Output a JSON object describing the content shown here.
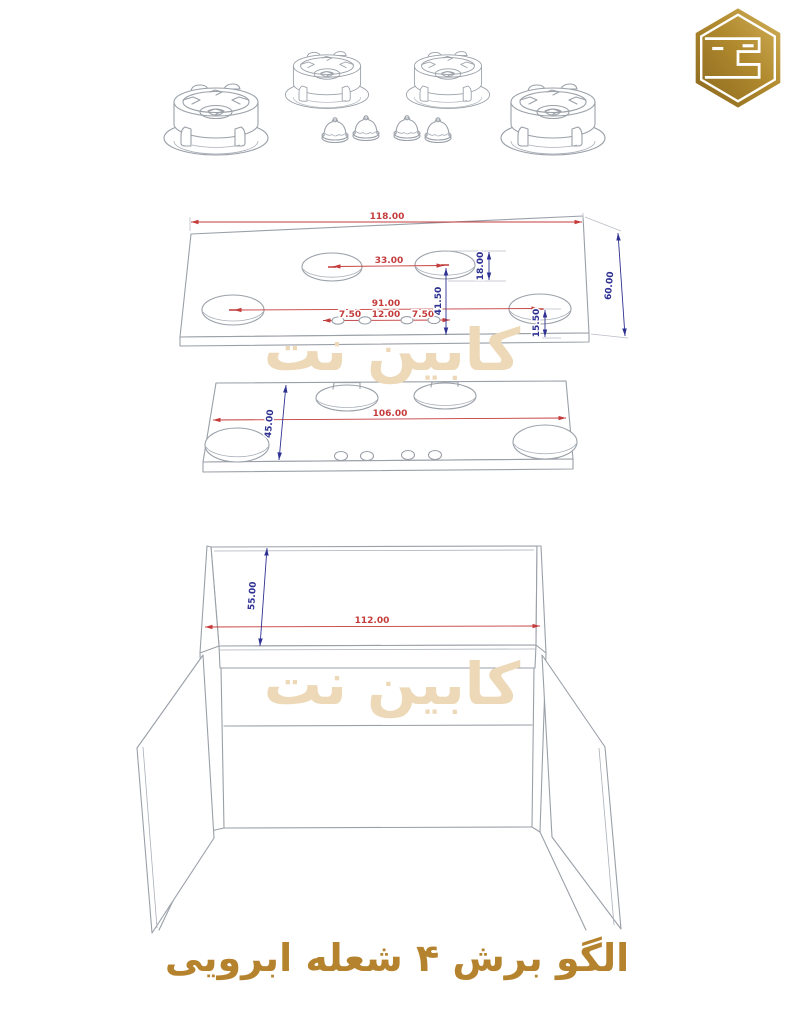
{
  "page": {
    "background": "#ffffff"
  },
  "logo": {
    "icon": "hexagon-c-logo",
    "letter": "C",
    "gold_dark": "#8a671e",
    "gold_light": "#d2b05a"
  },
  "watermark": {
    "text": "کابین نت",
    "color": "#edd9b8"
  },
  "title": {
    "text": "الگو برش ۴ شعله ابرویی",
    "color": "#b5832e"
  },
  "drawing": {
    "line_color": "#9aa0a8",
    "dim_color_horizontal": "#c43c3c",
    "dim_color_vertical": "#2e3192",
    "burners": {
      "count": 4,
      "caps_count": 4
    },
    "top_plate": {
      "dims": {
        "width": "118.00",
        "mid_hole_spacing": "33.00",
        "outer_hole_spacing": "91.00",
        "knob_left": "7.50",
        "knob_mid": "12.00",
        "knob_right": "7.50",
        "depth": "60.00",
        "mid_to_front": "41.50",
        "right_to_front": "15.50",
        "mid_to_back": "18.00"
      }
    },
    "lower_plate": {
      "dims": {
        "width": "106.00",
        "depth": "45.00"
      }
    },
    "cabinet": {
      "dims": {
        "width": "112.00",
        "top_depth": "55.00"
      }
    }
  }
}
